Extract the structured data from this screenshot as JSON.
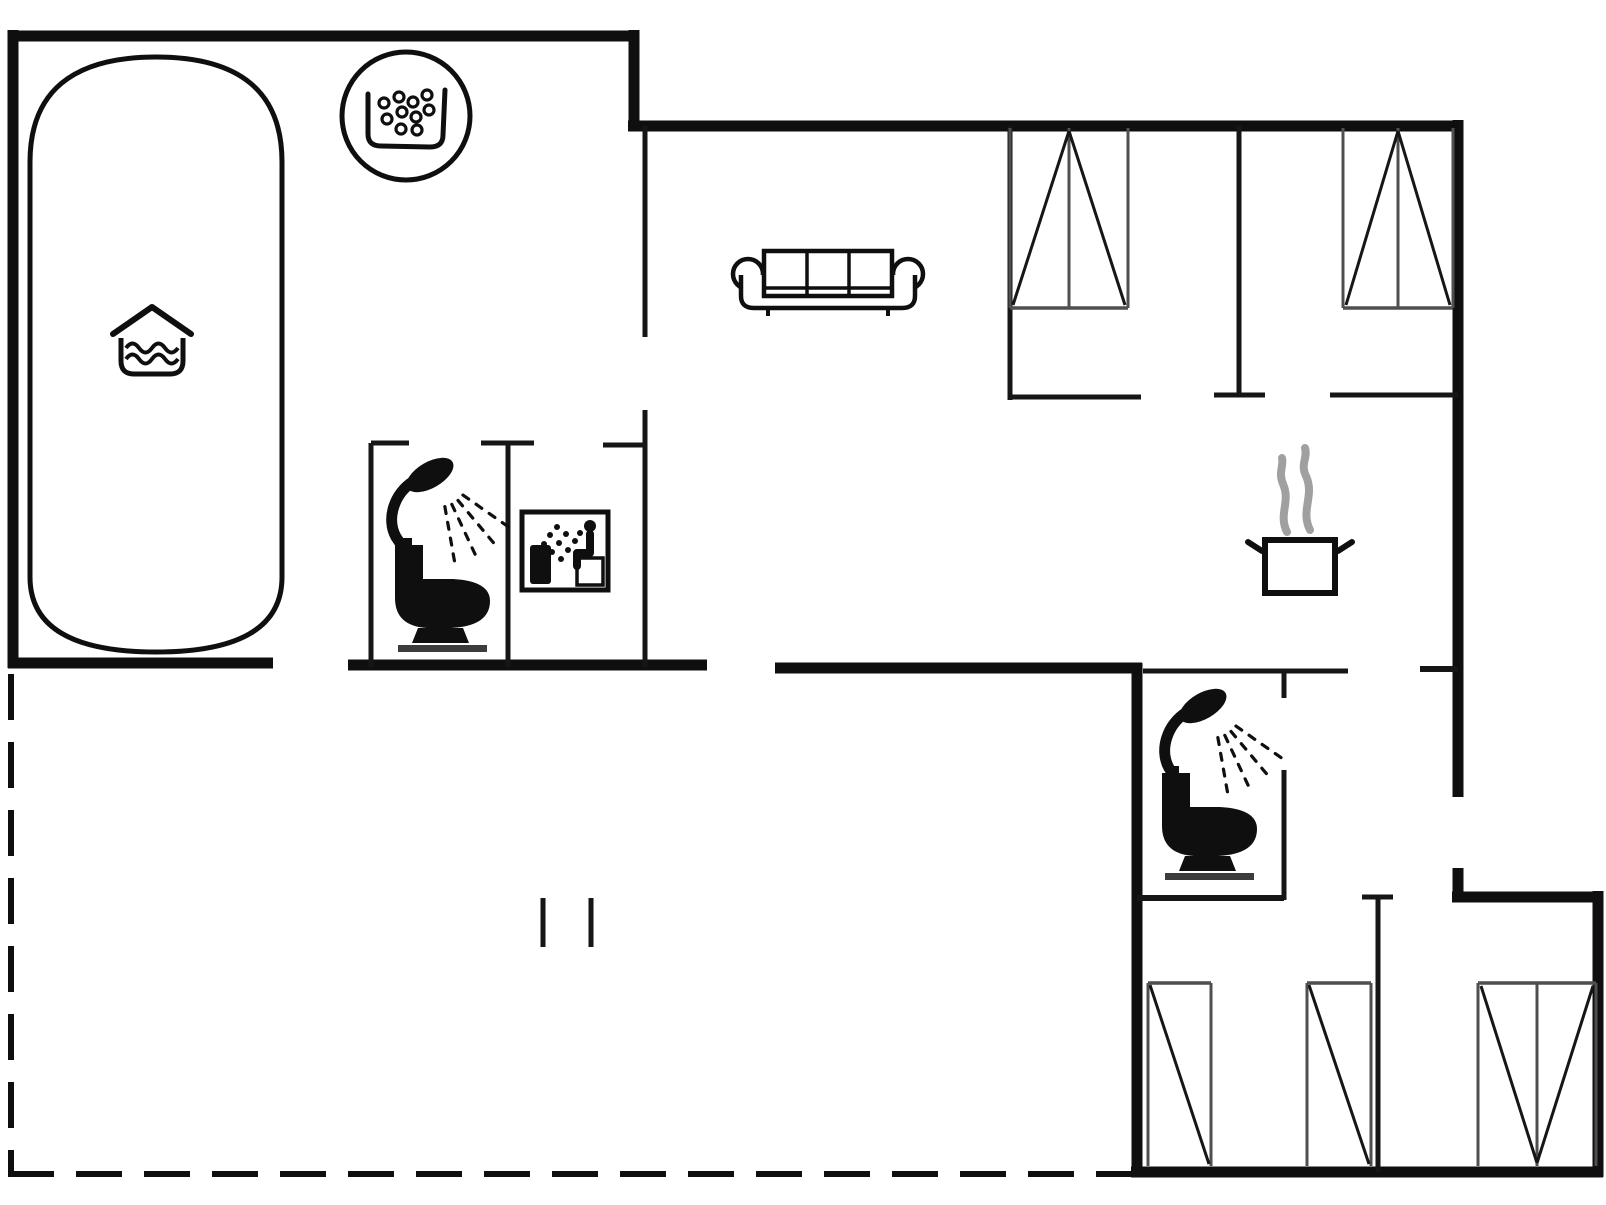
{
  "canvas": {
    "width": 1606,
    "height": 1205,
    "background": "#ffffff"
  },
  "colors": {
    "wall": "#0f0f0f",
    "interior": "#161616",
    "wardrobe": "#4f4f4f",
    "steam": "#a0a0a0",
    "toilet_base": "#3c3c3c",
    "fill_white": "#ffffff"
  },
  "walls": {
    "dash_pattern": [
      46,
      22
    ],
    "solid": [
      {
        "name": "outer-top-left",
        "x1": 8,
        "y1": 36,
        "x2": 639,
        "y2": 36,
        "w": 11
      },
      {
        "name": "outer-left",
        "x1": 13,
        "y1": 30,
        "x2": 13,
        "y2": 668,
        "w": 11
      },
      {
        "name": "outer-step-vertical",
        "x1": 634,
        "y1": 30,
        "x2": 634,
        "y2": 131,
        "w": 11
      },
      {
        "name": "outer-top-right",
        "x1": 628,
        "y1": 126,
        "x2": 1463,
        "y2": 126,
        "w": 11
      },
      {
        "name": "outer-right-upper",
        "x1": 1458,
        "y1": 120,
        "x2": 1458,
        "y2": 797,
        "w": 11
      },
      {
        "name": "outer-right-stub",
        "x1": 1458,
        "y1": 868,
        "x2": 1458,
        "y2": 902,
        "w": 11
      },
      {
        "name": "outer-step-right",
        "x1": 1452,
        "y1": 897,
        "x2": 1603,
        "y2": 897,
        "w": 11
      },
      {
        "name": "outer-right-lower",
        "x1": 1598,
        "y1": 891,
        "x2": 1598,
        "y2": 1177,
        "w": 11
      },
      {
        "name": "outer-bottom-right",
        "x1": 1131,
        "y1": 1172,
        "x2": 1603,
        "y2": 1172,
        "w": 11
      },
      {
        "name": "outer-mid-left",
        "x1": 1137,
        "y1": 663,
        "x2": 1137,
        "y2": 1177,
        "w": 11
      },
      {
        "name": "poolroom-bottom-a",
        "x1": 8,
        "y1": 663,
        "x2": 273,
        "y2": 663,
        "w": 11
      },
      {
        "name": "poolroom-bottom-b",
        "x1": 348,
        "y1": 665,
        "x2": 707,
        "y2": 665,
        "w": 11
      },
      {
        "name": "hall-bottom",
        "x1": 775,
        "y1": 668,
        "x2": 1142,
        "y2": 668,
        "w": 11
      },
      {
        "name": "living-upper-wall",
        "x1": 645,
        "y1": 126,
        "x2": 645,
        "y2": 337,
        "w": 5
      },
      {
        "name": "sauna-right-wall",
        "x1": 645,
        "y1": 410,
        "x2": 645,
        "y2": 667,
        "w": 5
      },
      {
        "name": "sauna-right-cap",
        "x1": 603,
        "y1": 445,
        "x2": 645,
        "y2": 445,
        "w": 5
      },
      {
        "name": "bath1-left-wall",
        "x1": 371,
        "y1": 443,
        "x2": 371,
        "y2": 667,
        "w": 5
      },
      {
        "name": "bath1-left-cap",
        "x1": 371,
        "y1": 443,
        "x2": 409,
        "y2": 443,
        "w": 5
      },
      {
        "name": "bath1-divider",
        "x1": 508,
        "y1": 443,
        "x2": 508,
        "y2": 667,
        "w": 5
      },
      {
        "name": "bath1-divider-cap",
        "x1": 481,
        "y1": 443,
        "x2": 534,
        "y2": 443,
        "w": 5
      },
      {
        "name": "bed1-left-wall",
        "x1": 1010,
        "y1": 126,
        "x2": 1010,
        "y2": 400,
        "w": 5
      },
      {
        "name": "bed1-bottom-wall",
        "x1": 1010,
        "y1": 397,
        "x2": 1141,
        "y2": 397,
        "w": 5
      },
      {
        "name": "bed-divider",
        "x1": 1239,
        "y1": 126,
        "x2": 1239,
        "y2": 397,
        "w": 5
      },
      {
        "name": "bed-divider-foot",
        "x1": 1214,
        "y1": 395,
        "x2": 1265,
        "y2": 395,
        "w": 5
      },
      {
        "name": "bed2-bottom-wall",
        "x1": 1330,
        "y1": 395,
        "x2": 1458,
        "y2": 395,
        "w": 5
      },
      {
        "name": "kitchen-south-a",
        "x1": 1143,
        "y1": 671,
        "x2": 1348,
        "y2": 671,
        "w": 5
      },
      {
        "name": "kitchen-south-b",
        "x1": 1420,
        "y1": 669,
        "x2": 1458,
        "y2": 669,
        "w": 6
      },
      {
        "name": "bath2-right-stub",
        "x1": 1284,
        "y1": 671,
        "x2": 1284,
        "y2": 698,
        "w": 5
      },
      {
        "name": "bath2-right-wall",
        "x1": 1284,
        "y1": 770,
        "x2": 1284,
        "y2": 900,
        "w": 5
      },
      {
        "name": "bath2-bottom-wall",
        "x1": 1137,
        "y1": 898,
        "x2": 1284,
        "y2": 898,
        "w": 6
      },
      {
        "name": "storage-divider",
        "x1": 1378,
        "y1": 897,
        "x2": 1378,
        "y2": 1172,
        "w": 5
      },
      {
        "name": "storage-divider-cap",
        "x1": 1362,
        "y1": 897,
        "x2": 1393,
        "y2": 897,
        "w": 5
      },
      {
        "name": "terrace-step-a",
        "x1": 543,
        "y1": 898,
        "x2": 543,
        "y2": 947,
        "w": 5
      },
      {
        "name": "terrace-step-b",
        "x1": 591,
        "y1": 898,
        "x2": 591,
        "y2": 947,
        "w": 5
      }
    ],
    "dashed": [
      {
        "name": "terrace-left",
        "x1": 11,
        "y1": 674,
        "x2": 11,
        "y2": 1172,
        "w": 6
      },
      {
        "name": "terrace-bottom",
        "x1": 8,
        "y1": 1174,
        "x2": 1134,
        "y2": 1174,
        "w": 6
      }
    ]
  },
  "fixtures": [
    {
      "type": "pool",
      "name": "swimming-pool",
      "x1": 30,
      "y1": 57,
      "x2": 282,
      "y2": 652,
      "r_top": 105,
      "r_bottom": 75
    },
    {
      "type": "pool_symbol",
      "name": "indoor-pool-icon",
      "cx": 152,
      "cy": 340
    },
    {
      "type": "whirlpool",
      "name": "whirlpool-icon",
      "cx": 406,
      "cy": 116,
      "r": 64
    },
    {
      "type": "sofa",
      "name": "sofa",
      "cx": 828,
      "cy": 280
    },
    {
      "type": "shower",
      "name": "shower-icon-bath1",
      "hx": 430,
      "hy": 475
    },
    {
      "type": "toilet",
      "name": "toilet-icon-bath1",
      "cx": 443,
      "cy": 596
    },
    {
      "type": "sauna",
      "name": "sauna-icon",
      "box": [
        522,
        512,
        608,
        590
      ]
    },
    {
      "type": "pot",
      "name": "cooking-pot-icon",
      "x": 1265,
      "y": 540,
      "w": 70,
      "h": 53
    },
    {
      "type": "shower",
      "name": "shower-icon-bath2",
      "hx": 1203,
      "hy": 706
    },
    {
      "type": "toilet",
      "name": "toilet-icon-bath2",
      "cx": 1210,
      "cy": 824
    },
    {
      "type": "wardrobe",
      "name": "wardrobe-bedroom-1",
      "variant": "peak",
      "box": [
        1010,
        128,
        1128,
        308
      ]
    },
    {
      "type": "wardrobe",
      "name": "wardrobe-bedroom-2",
      "variant": "peak",
      "box": [
        1343,
        128,
        1453,
        308
      ]
    },
    {
      "type": "wardrobe",
      "name": "wardrobe-storage-left",
      "variant": "slant",
      "box": [
        1148,
        983,
        1211,
        1166
      ]
    },
    {
      "type": "wardrobe",
      "name": "wardrobe-storage-mid",
      "variant": "slant",
      "box": [
        1307,
        983,
        1371,
        1166
      ]
    },
    {
      "type": "wardrobe",
      "name": "wardrobe-storage-right",
      "variant": "vee",
      "box": [
        1478,
        983,
        1596,
        1166
      ]
    }
  ]
}
